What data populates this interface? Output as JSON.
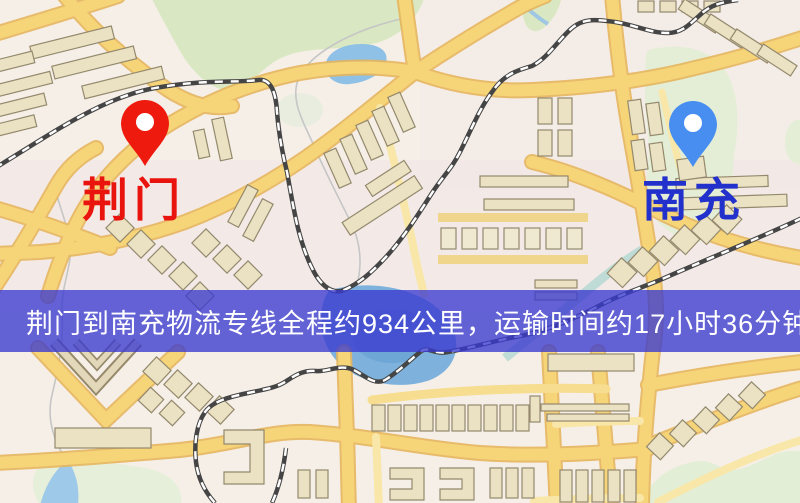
{
  "map": {
    "origin": {
      "name": "荆门",
      "marker_color": "#ee1a0e",
      "label_color": "#e9140e"
    },
    "destination": {
      "name": "南充",
      "marker_color": "#478ef0",
      "label_color": "#2231cc"
    }
  },
  "banner": {
    "text": "荆门到南充物流专线全程约934公里，运输时间约17小时36分钟.",
    "background_color": "#3a3ad0",
    "text_color": "#ffffff",
    "route": "荆门到南充物流专线",
    "distance": "约934公里",
    "duration": "约17小时36分钟"
  },
  "map_style": {
    "background_color": "#f5efe7",
    "road_color": "#f6d478",
    "road_casing_color": "#e2ae54",
    "minor_road_color": "#f8e7a8",
    "building_color": "#ebe2c4",
    "building_outline_color": "#94896d",
    "park_color": "#d9e8c2",
    "water_color": "#8fc0e6",
    "railway_color": "#444444"
  }
}
